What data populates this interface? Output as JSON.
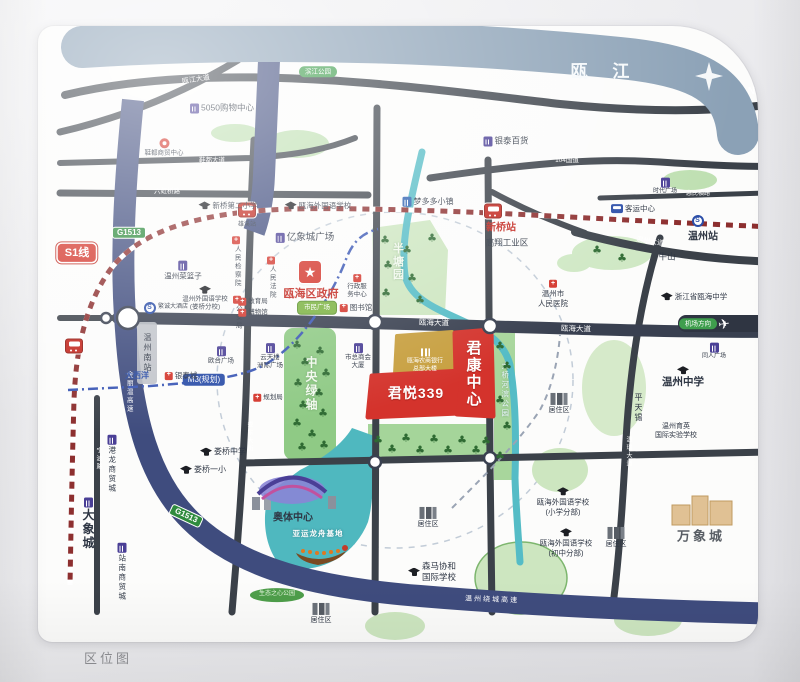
{
  "title": "区位图",
  "footer": {
    "caption": "区位图"
  },
  "colors": {
    "parcel_red": "#d4332c",
    "gold_parcel": "#c79f3f",
    "expressway_navy": "#3f4c7e",
    "river_band": "#8ba1b6",
    "road_dark": "#3b4149",
    "park_green": "#cde6c0",
    "axis_green": "#8fca85",
    "water_teal": "#4fb8bf",
    "rail_red": "#8d2f2f",
    "metro_blue": "#2b4ea8",
    "badge_green": "#2e8b3d"
  },
  "map": {
    "compass": "N",
    "labels": [
      {
        "n": "river-name",
        "t": "瓯 江",
        "x": 600,
        "y": 72,
        "c": "river"
      },
      {
        "n": "road-label-oujiang",
        "t": "瓯江大道",
        "x": 196,
        "y": 80,
        "c": "road s7",
        "r": -9
      },
      {
        "n": "road-label-xiedu",
        "t": "鞋都大道",
        "x": 212,
        "y": 161,
        "c": "road s65"
      },
      {
        "n": "road-label-liuhongqiao",
        "t": "六虹桥路",
        "x": 167,
        "y": 192,
        "c": "road s65"
      },
      {
        "n": "road-label-g104",
        "t": "104国道",
        "x": 567,
        "y": 161,
        "c": "road s65"
      },
      {
        "n": "road-label-huimin",
        "t": "惠民横路",
        "x": 698,
        "y": 195,
        "c": "road s6"
      },
      {
        "n": "road-label-wenzhou-ave",
        "t": "温州大道",
        "x": 650,
        "y": 242,
        "c": "road s7",
        "r": 9
      },
      {
        "n": "road-label-ouhai-ave-1",
        "t": "瓯海大道",
        "x": 434,
        "y": 323,
        "c": "road s75",
        "r": 2
      },
      {
        "n": "road-label-ouhai-ave-2",
        "t": "瓯海大道",
        "x": 576,
        "y": 329,
        "c": "road s75",
        "r": 2
      },
      {
        "n": "road-label-wenrui",
        "t": "温瑞大道",
        "x": 628,
        "y": 452,
        "c": "road v s6"
      },
      {
        "n": "road-label-loudong",
        "t": "娄东大街",
        "x": 249,
        "y": 437,
        "c": "road v s6"
      },
      {
        "n": "road-label-ningbo",
        "t": "宁波路",
        "x": 98,
        "y": 459,
        "c": "road v s6"
      },
      {
        "n": "road-label-jinliwen",
        "t": "金丽温高速",
        "x": 128,
        "y": 392,
        "c": "road v s65"
      },
      {
        "n": "road-label-raocheng",
        "t": "温州绕城高速",
        "x": 492,
        "y": 600,
        "c": "road s7 sp2",
        "r": 2
      },
      {
        "n": "s1-line-badge",
        "t": "S1线",
        "x": 77,
        "y": 253,
        "c": "badge-s1"
      },
      {
        "n": "m3-line-badge",
        "t": "M3(规划)",
        "x": 204,
        "y": 380,
        "c": "badge-m3"
      },
      {
        "n": "g1513-badge-south",
        "t": "G1513",
        "x": 186,
        "y": 516,
        "c": "badge-g",
        "r": 25
      },
      {
        "n": "g1513-badge-north",
        "t": "G1513",
        "x": 129,
        "y": 233,
        "c": "badge-g"
      },
      {
        "n": "airport-direction-badge",
        "t": "机场方向",
        "x": 698,
        "y": 324,
        "c": "pill-green"
      },
      {
        "n": "airplane-icon",
        "t": "✈",
        "x": 724,
        "y": 324,
        "c": "plane",
        "r": -8
      },
      {
        "n": "xinqiao-station-icon",
        "ic": "train",
        "x": 493,
        "y": 211
      },
      {
        "n": "xinqiao-station-label",
        "t": "新桥站",
        "x": 501,
        "y": 228,
        "c": "red-lbl s10 b"
      },
      {
        "n": "xiongxi-station-icon",
        "ic": "train",
        "x": 247,
        "y": 210
      },
      {
        "n": "xiongxi-station-label",
        "t": "雄溪站",
        "x": 247,
        "y": 226,
        "c": "s6"
      },
      {
        "n": "wenzhou-south-station-icon",
        "ic": "train",
        "x": 74,
        "y": 346
      },
      {
        "n": "wenzhou-south-station-label",
        "t": "温州南站",
        "x": 147,
        "y": 353,
        "c": "v s8"
      },
      {
        "n": "wenzhou-station-icon",
        "ic": "metro",
        "x": 698,
        "y": 221
      },
      {
        "n": "wenzhou-station-label",
        "t": "温州站",
        "x": 703,
        "y": 237,
        "c": "s10 b"
      },
      {
        "n": "poi-5050-mall",
        "t": "5050购物中心",
        "x": 222,
        "y": 108,
        "c": "s85",
        "ic": "b"
      },
      {
        "n": "poi-xiedu-center",
        "t": "鞋都商贸中心",
        "x": 164,
        "y": 148,
        "c": "s65 col",
        "ic": "redc"
      },
      {
        "n": "park-badge-binjiang",
        "t": "滨江公园",
        "x": 318,
        "y": 72,
        "c": "pill-green s6"
      },
      {
        "n": "poi-xinqiao-no2-primary",
        "t": "新桥第二小学",
        "x": 228,
        "y": 206,
        "c": "s75",
        "ic": "cap"
      },
      {
        "n": "poi-ouhai-foreign-school",
        "t": "瓯海外国语学校",
        "x": 318,
        "y": 206,
        "c": "s75",
        "ic": "cap"
      },
      {
        "n": "poi-mengduoduo-town",
        "t": "梦多多小镇",
        "x": 428,
        "y": 202,
        "c": "s8",
        "ic": "bb"
      },
      {
        "n": "poi-yintai-dept-store",
        "t": "银泰百货",
        "x": 506,
        "y": 141,
        "c": "s85",
        "ic": "b"
      },
      {
        "n": "poi-shidai-plaza",
        "t": "时代广场",
        "x": 665,
        "y": 187,
        "c": "s6 col",
        "ic": "b"
      },
      {
        "n": "poi-bus-terminal",
        "t": "客运中心",
        "x": 633,
        "y": 209,
        "c": "s75",
        "ic": "bus"
      },
      {
        "n": "poi-gaoxiang-industrial",
        "t": "高翔工业区",
        "x": 507,
        "y": 243,
        "c": "s85"
      },
      {
        "n": "poi-niushan",
        "t": "牛山",
        "x": 667,
        "y": 257,
        "c": "s85"
      },
      {
        "n": "poi-cailanzi",
        "t": "温州菜篮子",
        "x": 183,
        "y": 271,
        "c": "s75 col",
        "ic": "b"
      },
      {
        "n": "poi-foreign-school-louqiao",
        "t": "温州外国语学校\n(娄桥分校)",
        "x": 205,
        "y": 299,
        "c": "s65 col",
        "ic": "cap"
      },
      {
        "n": "poi-fancheng-hotel",
        "t": "繁诚大酒店",
        "x": 166,
        "y": 308,
        "c": "s6",
        "ic": "metro"
      },
      {
        "n": "poi-procuratorate",
        "t": "人民检察院",
        "x": 236,
        "y": 262,
        "c": "v s65 col",
        "ic": "red"
      },
      {
        "n": "poi-court",
        "t": "人民法院",
        "x": 271,
        "y": 278,
        "c": "v s65 col",
        "ic": "red"
      },
      {
        "n": "poi-public-security",
        "t": "公安局",
        "x": 237,
        "y": 313,
        "c": "v s65 col",
        "ic": "red"
      },
      {
        "n": "poi-education-bureau",
        "t": "教育局",
        "x": 253,
        "y": 302,
        "c": "s65",
        "ic": "red"
      },
      {
        "n": "poi-museum",
        "t": "博物馆",
        "x": 253,
        "y": 313,
        "c": "s65",
        "ic": "red"
      },
      {
        "n": "poi-yixiangcheng-plaza",
        "t": "亿象城广场",
        "x": 305,
        "y": 238,
        "c": "s95",
        "ic": "b"
      },
      {
        "n": "district-gov-icon",
        "ic": "star",
        "x": 310,
        "y": 272
      },
      {
        "n": "district-gov-label",
        "t": "瓯海区政府",
        "x": 311,
        "y": 294,
        "c": "red-lbl s11 b"
      },
      {
        "n": "civic-square-badge",
        "t": "市民广场",
        "x": 317,
        "y": 308,
        "c": "pill-grn2 s65"
      },
      {
        "n": "poi-library",
        "t": "图书馆",
        "x": 356,
        "y": 308,
        "c": "s75",
        "ic": "red"
      },
      {
        "n": "poi-admin-center",
        "t": "行政服\n务中心",
        "x": 357,
        "y": 287,
        "c": "s65 col",
        "ic": "red"
      },
      {
        "n": "bantang-park-label",
        "t": "半塘园",
        "x": 397,
        "y": 262,
        "c": "park-lbl v s11 sp2"
      },
      {
        "n": "poi-yuntianlou",
        "t": "云天楼\n洲际广场",
        "x": 270,
        "y": 357,
        "c": "s65 col",
        "ic": "b"
      },
      {
        "n": "poi-chamber-tower",
        "t": "市总商会\n大厦",
        "x": 358,
        "y": 357,
        "c": "s65 col",
        "ic": "b"
      },
      {
        "n": "poi-outai-plaza",
        "t": "欧台广场",
        "x": 221,
        "y": 356,
        "c": "s65 col",
        "ic": "b"
      },
      {
        "n": "poi-daxiyang",
        "t": "大西洋",
        "x": 137,
        "y": 376,
        "c": "blue-lbl s8 b"
      },
      {
        "n": "poi-yintaicheng",
        "t": "银泰城",
        "x": 181,
        "y": 376,
        "c": "s75",
        "ic": "red"
      },
      {
        "n": "poi-planning-bureau",
        "t": "规划局",
        "x": 268,
        "y": 398,
        "c": "s65",
        "ic": "red"
      },
      {
        "n": "central-axis-label",
        "t": "中央绿轴",
        "x": 311,
        "y": 384,
        "c": "park-lbl v s12 sp3"
      },
      {
        "n": "bank-parcel-label",
        "t": "瓯海农商银行\n总部大楼",
        "x": 425,
        "y": 361,
        "c": "gold s6 col",
        "ic": "bw"
      },
      {
        "n": "junkang-center-label",
        "t": "君康中心",
        "x": 473,
        "y": 374,
        "c": "parcel v s15 b sp2"
      },
      {
        "n": "junyue-339-label",
        "t": "君悦339",
        "x": 416,
        "y": 393,
        "c": "parcel s14 b sp1"
      },
      {
        "n": "riverside-park-label",
        "t": "大桥河滨公园",
        "x": 505,
        "y": 390,
        "c": "park-lbl2 v s75"
      },
      {
        "n": "poi-peoples-hospital",
        "t": "温州市\n人民医院",
        "x": 553,
        "y": 294,
        "c": "s75 col",
        "ic": "red"
      },
      {
        "n": "poi-ouhai-middle-school",
        "t": "浙江省瓯海中学",
        "x": 694,
        "y": 297,
        "c": "s75",
        "ic": "cap"
      },
      {
        "n": "poi-wenzhou-middle-school",
        "t": "温州中学",
        "x": 683,
        "y": 378,
        "c": "s105 b col",
        "ic": "cap"
      },
      {
        "n": "poi-tongren-plaza",
        "t": "同人广场",
        "x": 714,
        "y": 352,
        "c": "s6 col",
        "ic": "b"
      },
      {
        "n": "poi-pingtianxi",
        "t": "平天锡",
        "x": 638,
        "y": 408,
        "c": "v s8"
      },
      {
        "n": "poi-yuying-school",
        "t": "温州育英\n国际实验学校",
        "x": 676,
        "y": 431,
        "c": "s7"
      },
      {
        "n": "residential-label-1",
        "t": "居住区",
        "x": 559,
        "y": 404,
        "c": "s7 col",
        "ic": "bg"
      },
      {
        "n": "residential-label-2",
        "t": "居住区",
        "x": 616,
        "y": 538,
        "c": "s7 col",
        "ic": "bg"
      },
      {
        "n": "residential-label-3",
        "t": "居住区",
        "x": 428,
        "y": 518,
        "c": "s7 col",
        "ic": "bg"
      },
      {
        "n": "residential-label-4",
        "t": "居住区",
        "x": 321,
        "y": 614,
        "c": "s7 col",
        "ic": "bg"
      },
      {
        "n": "poi-foreign-school-primary",
        "t": "瓯海外国语学校\n(小学分部)",
        "x": 563,
        "y": 502,
        "c": "s75 col",
        "ic": "cap"
      },
      {
        "n": "poi-foreign-school-junior",
        "t": "瓯海外国语学校\n(初中分部)",
        "x": 566,
        "y": 543,
        "c": "s75 col",
        "ic": "cap"
      },
      {
        "n": "mixc-label",
        "t": "万象城",
        "x": 701,
        "y": 537,
        "c": "s13 b sp3 gray"
      },
      {
        "n": "poi-louqiao-middle",
        "t": "娄桥中学",
        "x": 223,
        "y": 452,
        "c": "s8",
        "ic": "cap"
      },
      {
        "n": "poi-louqiao-primary",
        "t": "娄桥一小",
        "x": 203,
        "y": 470,
        "c": "s8",
        "ic": "cap"
      },
      {
        "n": "poi-daxiangcheng",
        "t": "大象城",
        "x": 88,
        "y": 524,
        "c": "v s12 b col",
        "ic": "b"
      },
      {
        "n": "poi-ganglong-trade-city",
        "t": "港龙商贸城",
        "x": 112,
        "y": 464,
        "c": "v s75 col",
        "ic": "b"
      },
      {
        "n": "poi-zhannan-trade-city",
        "t": "站南商贸城",
        "x": 122,
        "y": 572,
        "c": "v s75 col",
        "ic": "b"
      },
      {
        "n": "olympic-center-label",
        "t": "奥体中心",
        "x": 293,
        "y": 518,
        "c": "s10 b"
      },
      {
        "n": "dragon-boat-base-label",
        "t": "亚运龙舟基地",
        "x": 318,
        "y": 534,
        "c": "water s75 sp1"
      },
      {
        "n": "poi-senma-xiehe-school",
        "t": "森马协和\n国际学校",
        "x": 432,
        "y": 572,
        "c": "s85",
        "ic": "cap"
      },
      {
        "n": "eco-park-badge",
        "t": "生态之心公园",
        "x": 277,
        "y": 595,
        "c": "pill-eco s6"
      }
    ]
  }
}
